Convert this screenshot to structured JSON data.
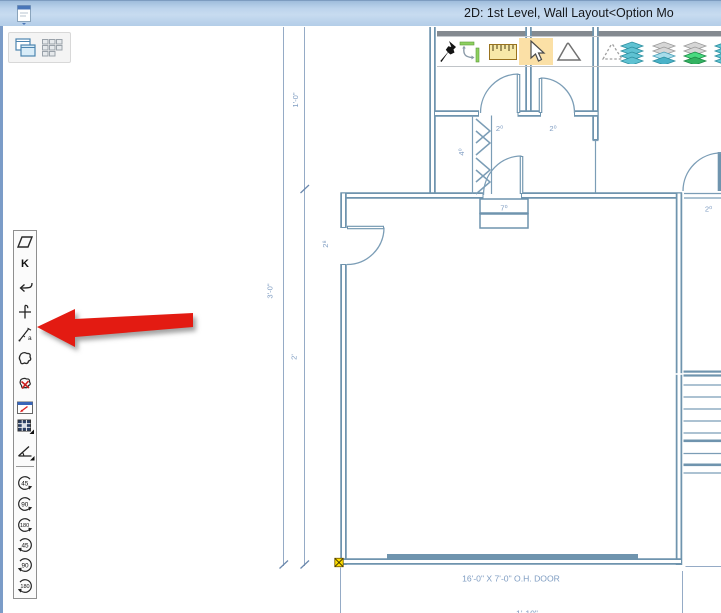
{
  "window": {
    "title": "2D: 1st Level, Wall Layout<Option Mo",
    "title_bg": "#bdd4ec",
    "border_color": "#7b9cc8"
  },
  "window_controls": {
    "icons": [
      {
        "name": "cascade-windows"
      },
      {
        "name": "tile-windows"
      }
    ]
  },
  "top_toolbar": {
    "selected_bg": "#fbe0a6",
    "icons": [
      {
        "name": "pushpin"
      },
      {
        "name": "rotate-resize"
      },
      {
        "name": "ruler"
      },
      {
        "name": "select-arrow",
        "selected": true
      },
      {
        "name": "polygon"
      },
      {
        "name": "polygon-dashed"
      },
      {
        "name": "layers-teal"
      },
      {
        "name": "layers-mixed"
      },
      {
        "name": "layers-green"
      },
      {
        "name": "layers-partial"
      }
    ]
  },
  "side_toolbar": {
    "k_label": "K",
    "a_label": "a",
    "rotate_ccw": [
      "45",
      "90",
      "180"
    ],
    "rotate_cw": [
      "45",
      "90",
      "180"
    ]
  },
  "plan": {
    "dimensions": {
      "outer_total": "3'-0\"",
      "upper": "1'-0\"",
      "lower": "2'",
      "bottom_partial": "1'-10\""
    },
    "door_labels": {
      "hall_left": "2⁰",
      "hall_right": "2⁰",
      "closet_bifold": "4⁰",
      "garage_step": "7⁰",
      "garage_side_door": "2⁸",
      "right_room_door": "2⁰"
    },
    "annotations": {
      "garage_door": "16'-0\" X 7'-0\" O.H. DOOR"
    },
    "colors": {
      "wall": "#6f94ae",
      "dimension_line": "#95abc6",
      "label_text": "#7f9dc2",
      "selection_marker": "#ffdf00"
    }
  },
  "annotation_arrow": {
    "color": "#e31b12"
  }
}
